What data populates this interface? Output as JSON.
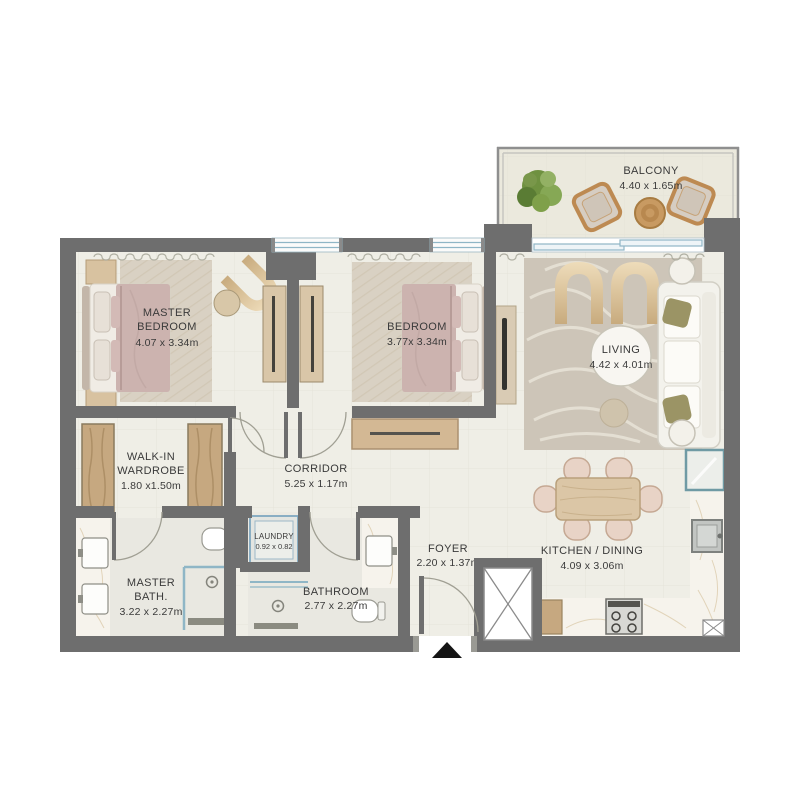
{
  "plan_title": "2-bedroom apartment floor plan",
  "colors": {
    "wall": "#6e6e6e",
    "floor": "#efeee6",
    "bath_floor": "#e9e8e1",
    "wood": "#c9ab85",
    "bed_blanket": "#ccb3af",
    "glass": "#8fb6c6",
    "olive_pillow": "#9b9465",
    "rattan": "#bd8a52",
    "marble": "#f6f3ec",
    "label_text": "#3a3a3a"
  },
  "rooms": {
    "balcony": {
      "label": "BALCONY",
      "dims": "4.40 x 1.65m"
    },
    "master_bedroom": {
      "label_line1": "MASTER",
      "label_line2": "BEDROOM",
      "dims": "4.07 x 3.34m"
    },
    "bedroom": {
      "label": "BEDROOM",
      "dims": "3.77x 3.34m"
    },
    "living": {
      "label": "LIVING",
      "dims": "4.42 x 4.01m"
    },
    "walk_in_wardrobe": {
      "label_line1": "WALK-IN",
      "label_line2": "WARDROBE",
      "dims": "1.80 x1.50m"
    },
    "corridor": {
      "label": "CORRIDOR",
      "dims": "5.25 x 1.17m"
    },
    "laundry": {
      "label": "LAUNDRY",
      "dims": "0.92 x 0.82"
    },
    "master_bath": {
      "label_line1": "MASTER",
      "label_line2": "BATH.",
      "dims": "3.22 x 2.27m"
    },
    "bathroom": {
      "label": "BATHROOM",
      "dims": "2.77 x 2.27m"
    },
    "foyer": {
      "label": "FOYER",
      "dims": "2.20 x 1.37m"
    },
    "kitchen_dining": {
      "label": "KITCHEN / DINING",
      "dims": "4.09 x 3.06m"
    }
  }
}
